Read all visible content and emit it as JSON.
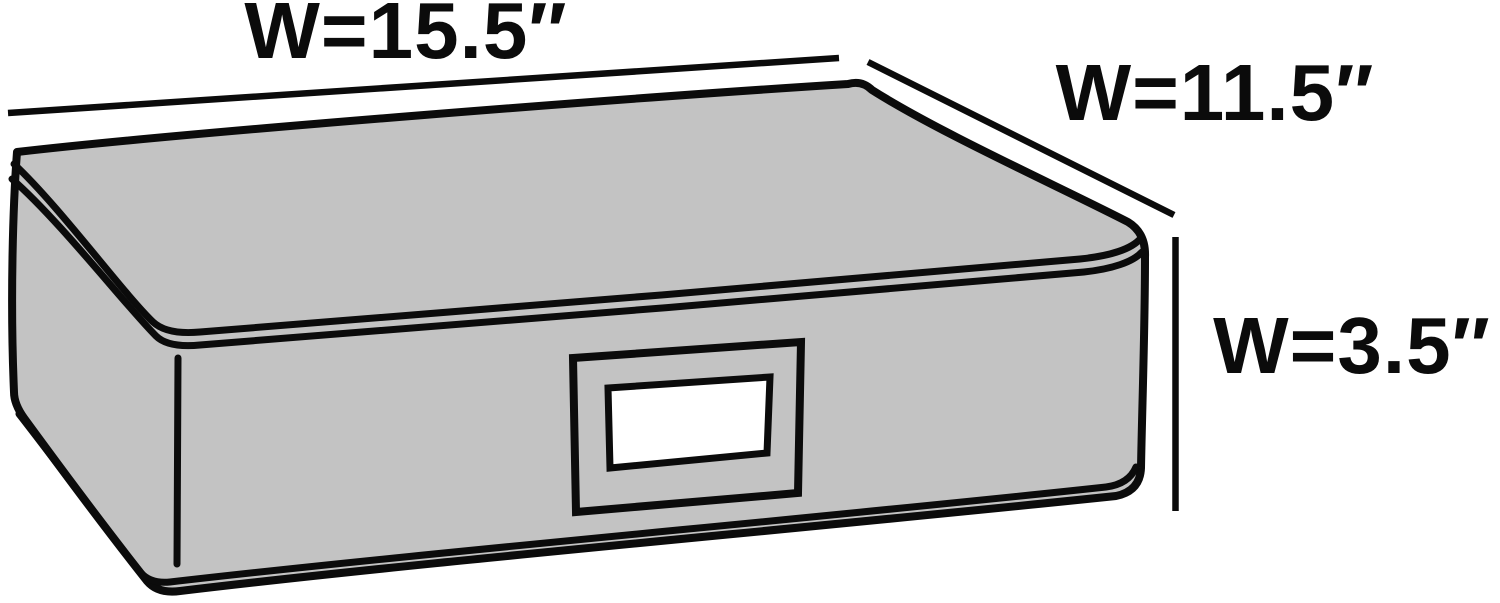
{
  "diagram": {
    "subject": "storage-box-dimension-diagram",
    "dimensions": {
      "width_label": "W=15.5″",
      "depth_label": "W=11.5″",
      "height_label": "W=3.5″"
    },
    "colors": {
      "background": "#ffffff",
      "box_fill": "#c3c3c3",
      "line": "#0b0b0b",
      "window_fill": "#ffffff"
    }
  }
}
